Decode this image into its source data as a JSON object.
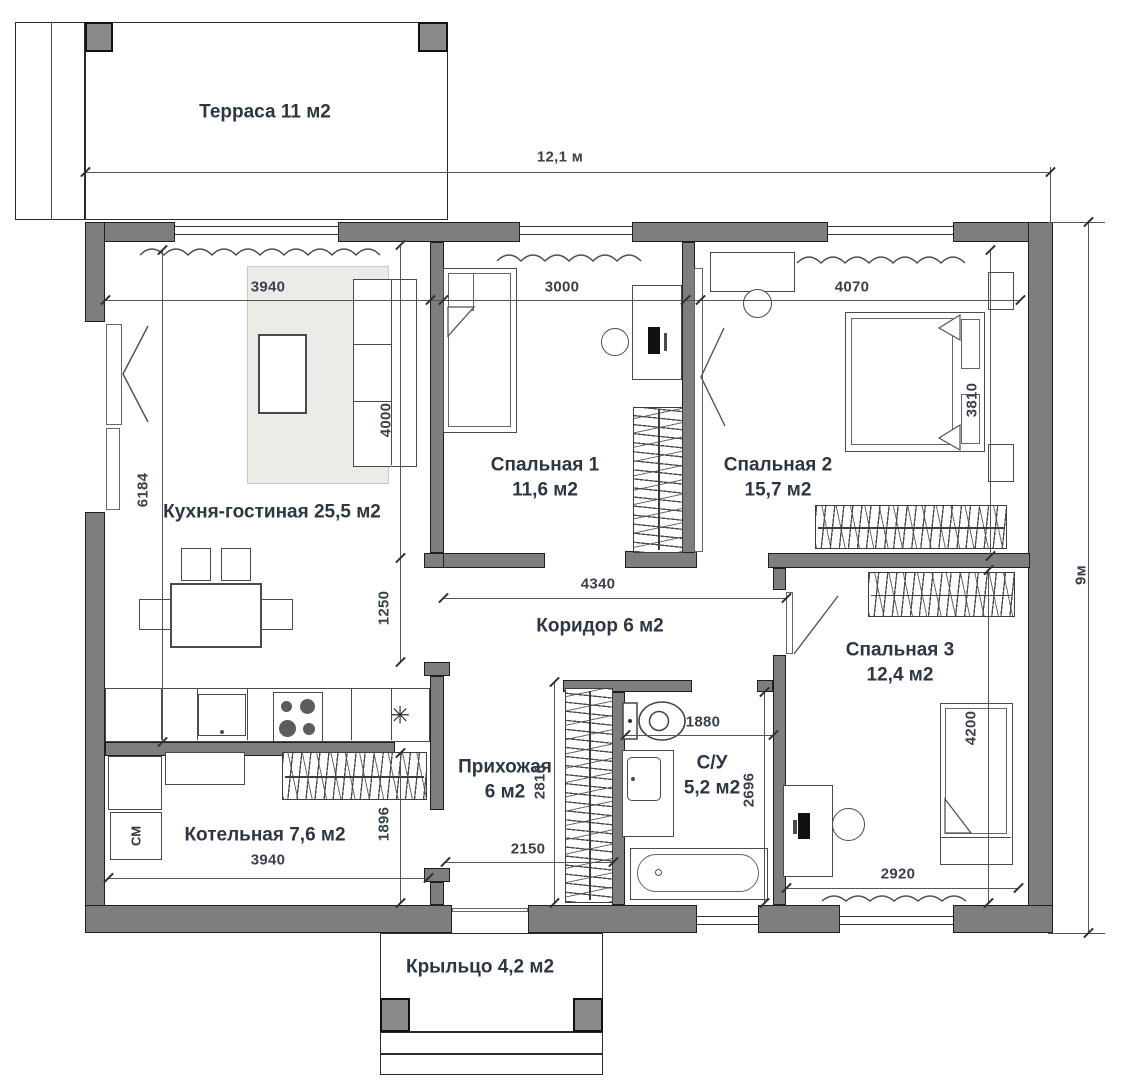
{
  "plan": {
    "rooms": {
      "terrace": {
        "label": "Терраса 11 м2"
      },
      "kitchen_living": {
        "label": "Кухня-гостиная 25,5 м2"
      },
      "bedroom1": {
        "name": "Спальная 1",
        "area": "11,6 м2"
      },
      "bedroom2": {
        "name": "Спальная 2",
        "area": "15,7 м2"
      },
      "bedroom3": {
        "name": "Спальная 3",
        "area": "12,4 м2"
      },
      "corridor": {
        "label": "Коридор 6 м2"
      },
      "hallway": {
        "name": "Прихожая",
        "area": "6 м2"
      },
      "bathroom": {
        "name": "С/У",
        "area": "5,2 м2"
      },
      "boiler": {
        "label": "Котельная 7,6 м2"
      },
      "porch": {
        "label": "Крыльцо 4,2 м2"
      }
    },
    "dimensions": {
      "overall_width": "12,1 м",
      "overall_depth": "9м",
      "kitchen_top": "3940",
      "bedroom1_top": "3000",
      "bedroom2_top": "4070",
      "kitchen_left": "6184",
      "kitchen_inner": "4000",
      "opening": "1250",
      "corridor_len": "4340",
      "bathroom_width": "1880",
      "bathroom_depth": "2696",
      "hallway_depth": "2816",
      "boiler_depth": "1896",
      "boiler_width": "3940",
      "hallway_width": "2150",
      "bedroom3_width": "2920",
      "bedroom3_depth": "4200",
      "bedroom2_side": "3810"
    },
    "annotations": {
      "washing_machine": "СМ",
      "vent_symbol": "✳"
    },
    "colors": {
      "wall": "#7e7e7e",
      "label_text": "#2d3643",
      "dim_text": "#3a414d"
    }
  }
}
